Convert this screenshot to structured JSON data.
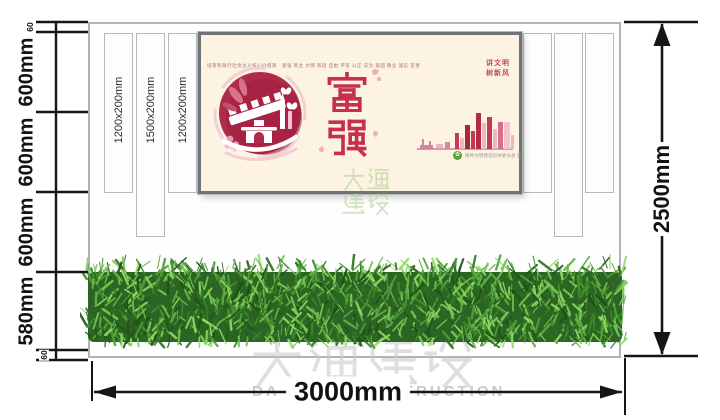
{
  "annotations": {
    "left_chain": [
      "60",
      "600mm",
      "600mm",
      "600mm",
      "580mm",
      "60"
    ],
    "width_label": "3000mm",
    "height_label": "2500mm",
    "strip_labels": [
      "1200x200mm",
      "1500x200mm",
      "1200x200mm"
    ]
  },
  "poster": {
    "values_line": "培育和践行社会主义核心价值观　富强 民主 文明 和谐 自由 平等 公正 法治 爱国 敬业 诚信 友善",
    "main_chars": "富强",
    "slogan_line1": "讲文明",
    "slogan_line2": "树新风",
    "credit": "精神文明建设指导委员会 宣"
  },
  "watermark": {
    "cn": "大通建设",
    "en": "DA TONG CONSTRUCTION"
  },
  "colors": {
    "poster_bg": "#fcf3e3",
    "poster_red": "#c62f4d",
    "hedge_green": "#3c8a2c",
    "dimension_line": "#161616",
    "watermark_gray": "#c9c9c9",
    "stamp_green": "#a3cc85"
  }
}
